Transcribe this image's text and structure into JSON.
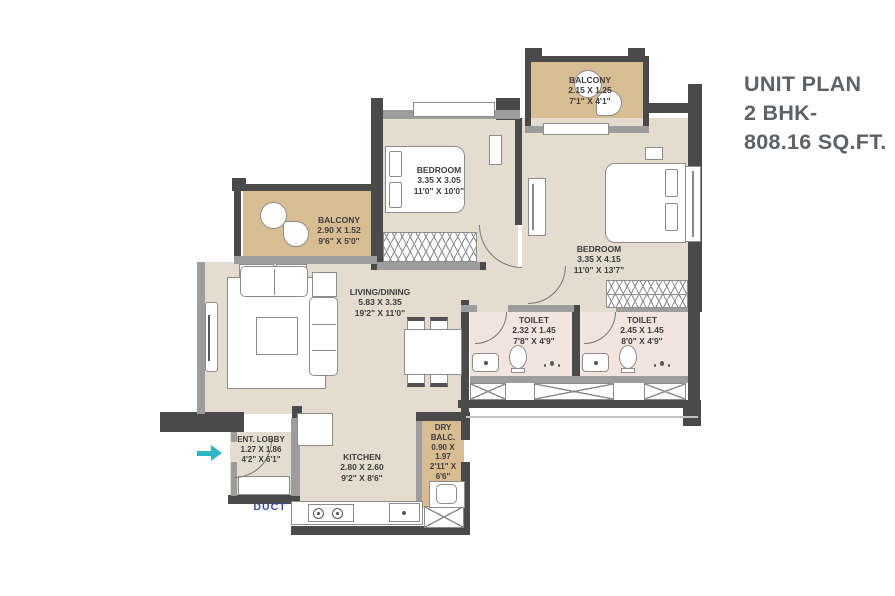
{
  "title": {
    "line1": "UNIT PLAN",
    "line2": "2 BHK-",
    "line3": "808.16 SQ.FT."
  },
  "rooms": [
    {
      "id": "balcony-top",
      "name": "BALCONY",
      "dim_m": "2.15 X 1.25",
      "dim_ft": "7'1\" X 4'1\""
    },
    {
      "id": "bedroom-1",
      "name": "BEDROOM",
      "dim_m": "3.35 X 3.05",
      "dim_ft": "11'0\" X 10'0\""
    },
    {
      "id": "bedroom-2",
      "name": "BEDROOM",
      "dim_m": "3.35 X 4.15",
      "dim_ft": "11'0\" X 13'7\""
    },
    {
      "id": "balcony-left",
      "name": "BALCONY",
      "dim_m": "2.90 X 1.52",
      "dim_ft": "9'6\" X 5'0\""
    },
    {
      "id": "living-dining",
      "name": "LIVING/DINING",
      "dim_m": "5.83 X 3.35",
      "dim_ft": "19'2\" X 11'0\""
    },
    {
      "id": "toilet-1",
      "name": "TOILET",
      "dim_m": "2.32 X 1.45",
      "dim_ft": "7'8\" X 4'9\""
    },
    {
      "id": "toilet-2",
      "name": "TOILET",
      "dim_m": "2.45 X 1.45",
      "dim_ft": "8'0\" X 4'9\""
    },
    {
      "id": "ent-lobby",
      "name": "ENT. LOBBY",
      "dim_m": "1.27 X 1.86",
      "dim_ft": "4'2\" X 6'1\""
    },
    {
      "id": "kitchen",
      "name": "KITCHEN",
      "dim_m": "2.80 X 2.60",
      "dim_ft": "9'2\" X 8'6\""
    },
    {
      "id": "dry-balcony",
      "name": "DRY BALC.",
      "dim_m": "0.90 X 1.97",
      "dim_ft": "2'11\" X 6'6\""
    }
  ],
  "labels": {
    "duct": "DUCT"
  },
  "colors": {
    "wall_dark": "#4a4a4a",
    "wall_light": "#9d9d9d",
    "floor_room": "#e4ddcf",
    "floor_balcony": "#d8bd92",
    "floor_toilet": "#f2e4df",
    "entry_arrow": "#2fb5c8",
    "duct_text": "#3b4a9b",
    "title_text": "#5d6267"
  }
}
